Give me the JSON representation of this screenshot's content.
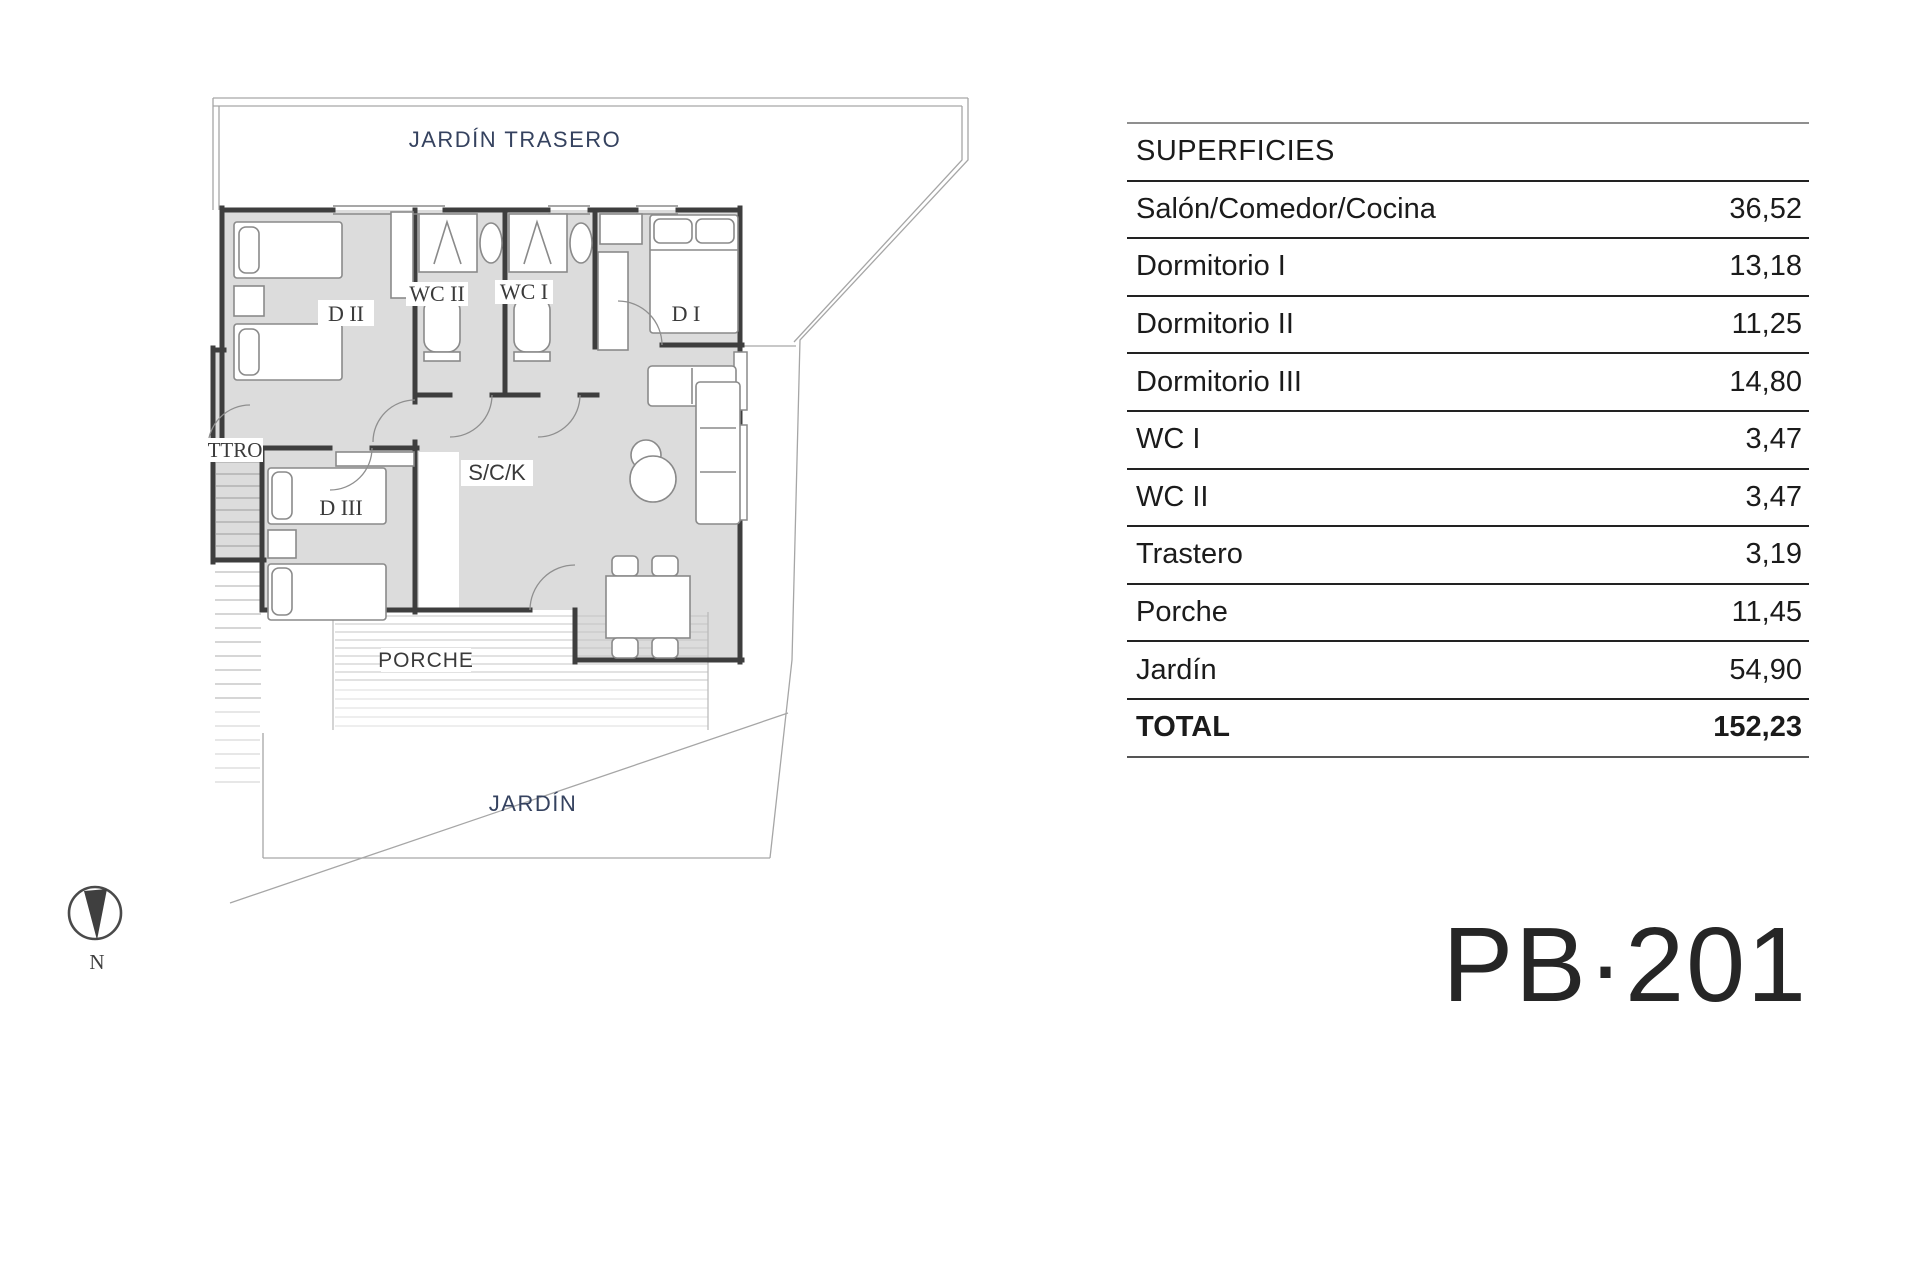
{
  "table": {
    "header": "SUPERFICIES",
    "rows": [
      {
        "label": "Salón/Comedor/Cocina",
        "value": "36,52"
      },
      {
        "label": "Dormitorio I",
        "value": "13,18"
      },
      {
        "label": "Dormitorio II",
        "value": "11,25"
      },
      {
        "label": "Dormitorio III",
        "value": "14,80"
      },
      {
        "label": "WC I",
        "value": "3,47"
      },
      {
        "label": "WC II",
        "value": "3,47"
      },
      {
        "label": "Trastero",
        "value": "3,19"
      },
      {
        "label": "Porche",
        "value": "11,45"
      },
      {
        "label": "Jardín",
        "value": "54,90"
      }
    ],
    "total": {
      "label": "TOTAL",
      "value": "152,23"
    }
  },
  "plan": {
    "labels": {
      "back_garden": "JARDÍN TRASERO",
      "bedroom2": "D II",
      "wc2": "WC II",
      "wc1": "WC I",
      "bedroom1": "D I",
      "trastero": "TTRO",
      "bedroom3": "D III",
      "living": "S/C/K",
      "porch": "PORCHE",
      "garden": "JARDÍN"
    },
    "compass_label": "N"
  },
  "plan_id": "PB·201",
  "colors": {
    "garden_label": "#35425f",
    "room_label": "#3a3a3a",
    "wall": "#3e3e3e",
    "room_fill": "#dcdcdc",
    "boundary": "#a6a6a6"
  }
}
